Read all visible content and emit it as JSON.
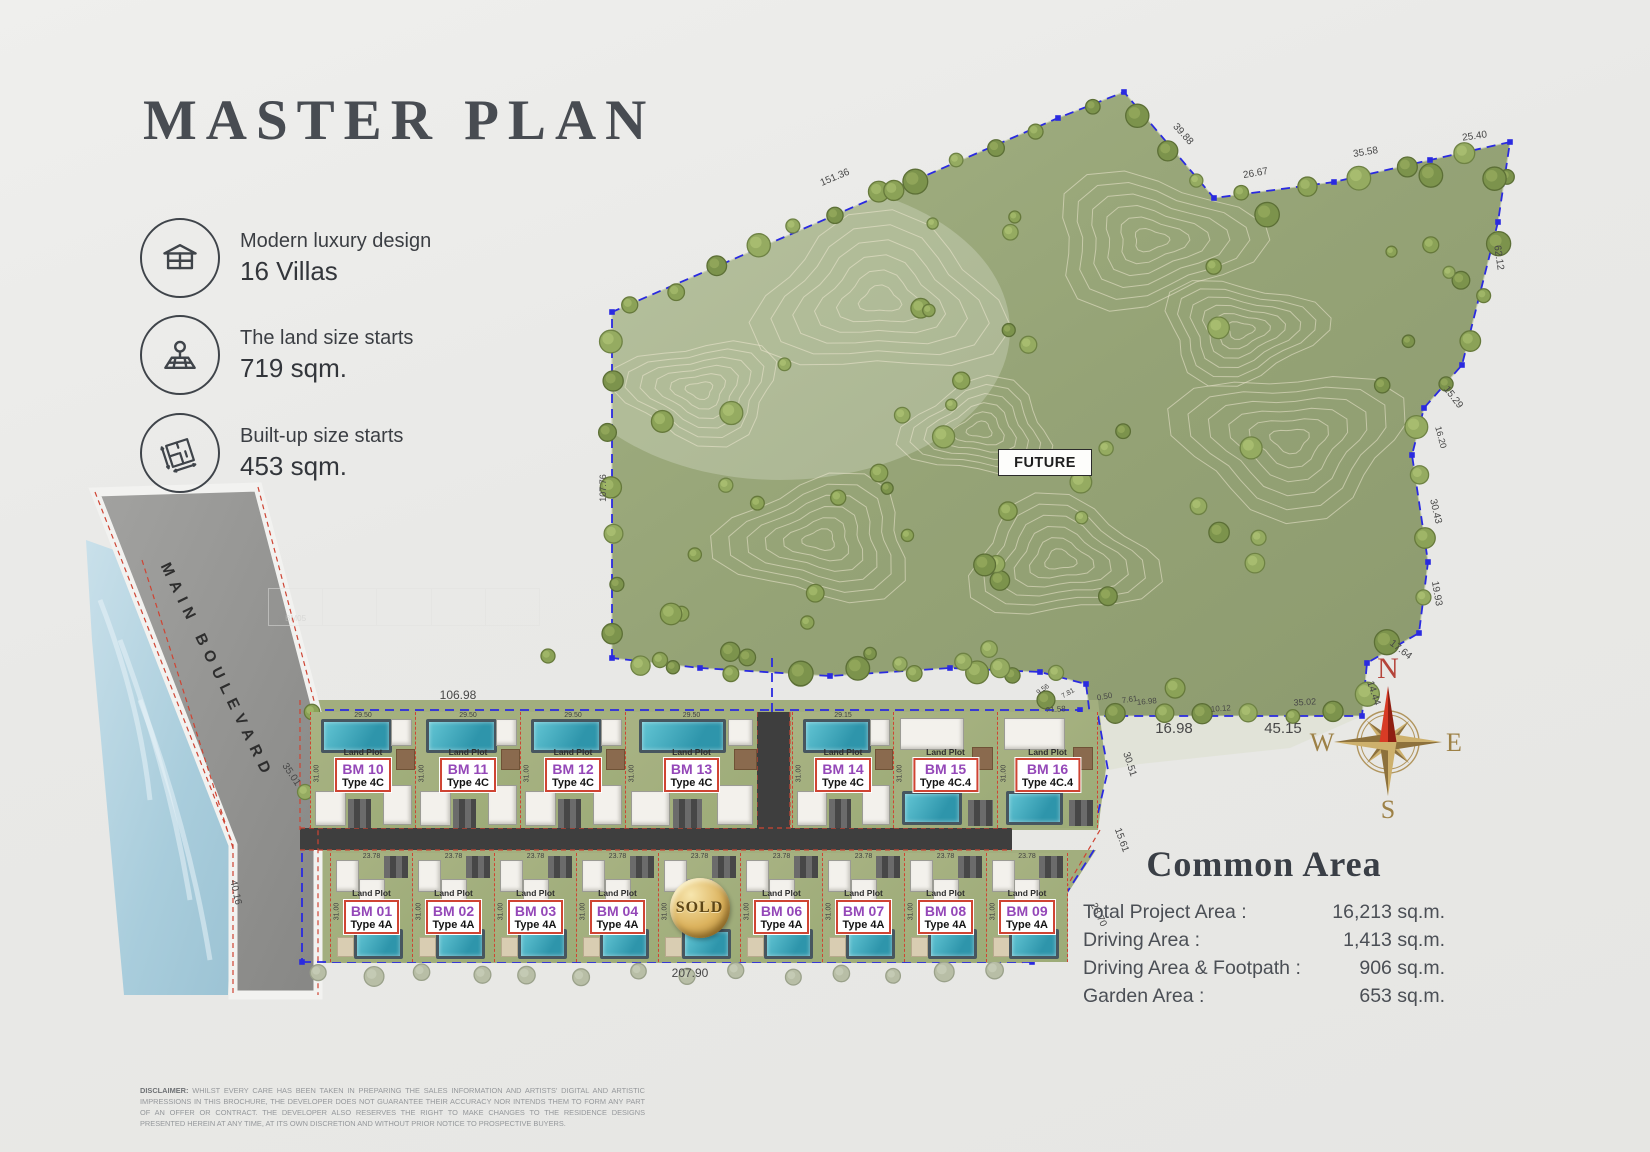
{
  "title": "MASTER PLAN",
  "features": [
    {
      "icon": "villa-icon",
      "line1": "Modern luxury design",
      "line2": "16 Villas"
    },
    {
      "icon": "land-size-icon",
      "line1": "The land size starts",
      "line2": "719 sqm."
    },
    {
      "icon": "built-up-icon",
      "line1": "Built-up size starts",
      "line2": "453 sqm."
    }
  ],
  "map": {
    "future_label": "FUTURE",
    "boulevard_label": "MAIN BOULEVARD",
    "sold_label": "SOLD",
    "land_plot_label": "Land Plot",
    "ghost_label": "BM05",
    "compass": {
      "n": "N",
      "e": "E",
      "s": "S",
      "w": "W"
    },
    "colors": {
      "boundary_blue": "#2a2ae0",
      "boundary_red": "#cf4433",
      "plot_id_purple": "#9447b8",
      "sold_gold": "#dcb35e",
      "grass": "#96a379",
      "pool_teal": "#3ba4b8"
    },
    "top_row_plots": [
      {
        "id": "BM 10",
        "type": "Type 4C",
        "width": "29.50",
        "depth": "31.00",
        "pool": "top"
      },
      {
        "id": "BM 11",
        "type": "Type 4C",
        "width": "29.50",
        "depth": "31.00",
        "pool": "top"
      },
      {
        "id": "BM 12",
        "type": "Type 4C",
        "width": "29.50",
        "depth": "31.00",
        "pool": "top"
      },
      {
        "id": "BM 13",
        "type": "Type 4C",
        "width": "29.50",
        "depth": "31.00",
        "pool": "top"
      },
      {
        "id": "BM 14",
        "type": "Type 4C",
        "width": "29.15",
        "depth": "31.00",
        "pool": "top"
      },
      {
        "id": "BM 15",
        "type": "Type 4C.4",
        "width": "",
        "depth": "31.00",
        "pool": "bottom"
      },
      {
        "id": "BM 16",
        "type": "Type 4C.4",
        "width": "",
        "depth": "31.00",
        "pool": "bottom"
      }
    ],
    "bottom_row_plots": [
      {
        "id": "BM 01",
        "type": "Type 4A",
        "width": "23.78",
        "depth": "31.00"
      },
      {
        "id": "BM 02",
        "type": "Type 4A",
        "width": "23.78",
        "depth": "31.00"
      },
      {
        "id": "BM 03",
        "type": "Type 4A",
        "width": "23.78",
        "depth": "31.00"
      },
      {
        "id": "BM 04",
        "type": "Type 4A",
        "width": "23.78",
        "depth": "31.00"
      },
      {
        "sold": true,
        "width": "23.78",
        "depth": "31.00"
      },
      {
        "id": "BM 06",
        "type": "Type 4A",
        "width": "23.78",
        "depth": "31.00"
      },
      {
        "id": "BM 07",
        "type": "Type 4A",
        "width": "23.78",
        "depth": "31.00"
      },
      {
        "id": "BM 08",
        "type": "Type 4A",
        "width": "23.78",
        "depth": "31.00"
      },
      {
        "id": "BM 09",
        "type": "Type 4A",
        "width": "23.78",
        "depth": "31.00"
      }
    ],
    "dimensions": [
      {
        "t": "151.36",
        "x": 836,
        "y": 180,
        "r": -23,
        "s": 10
      },
      {
        "t": "39.88",
        "x": 1181,
        "y": 136,
        "r": 48,
        "s": 10
      },
      {
        "t": "26.67",
        "x": 1256,
        "y": 176,
        "r": -10,
        "s": 10
      },
      {
        "t": "35.58",
        "x": 1366,
        "y": 155,
        "r": -9,
        "s": 10
      },
      {
        "t": "25.40",
        "x": 1475,
        "y": 139,
        "r": -8,
        "s": 10
      },
      {
        "t": "62.12",
        "x": 1496,
        "y": 258,
        "r": 82,
        "s": 10
      },
      {
        "t": "15.29",
        "x": 1451,
        "y": 399,
        "r": 52,
        "s": 10
      },
      {
        "t": "16.20",
        "x": 1438,
        "y": 438,
        "r": 75,
        "s": 9
      },
      {
        "t": "30.43",
        "x": 1433,
        "y": 512,
        "r": 77,
        "s": 10
      },
      {
        "t": "19.93",
        "x": 1434,
        "y": 594,
        "r": 80,
        "s": 10
      },
      {
        "t": "17.64",
        "x": 1399,
        "y": 652,
        "r": 38,
        "s": 10
      },
      {
        "t": "14.44",
        "x": 1371,
        "y": 694,
        "r": 72,
        "s": 10
      },
      {
        "t": "107.76",
        "x": 606,
        "y": 488,
        "r": -90,
        "s": 9
      },
      {
        "t": "35.02",
        "x": 1305,
        "y": 705,
        "r": -3,
        "s": 9
      },
      {
        "t": "9.56",
        "x": 1044,
        "y": 691,
        "r": -35,
        "s": 7
      },
      {
        "t": "7.81",
        "x": 1069,
        "y": 695,
        "r": -30,
        "s": 7
      },
      {
        "t": "0.50",
        "x": 1105,
        "y": 699,
        "r": -10,
        "s": 8
      },
      {
        "t": "7.61",
        "x": 1130,
        "y": 702,
        "r": -8,
        "s": 8
      },
      {
        "t": "16.98",
        "x": 1147,
        "y": 704,
        "r": -5,
        "s": 8
      },
      {
        "t": "10.12",
        "x": 1221,
        "y": 711,
        "r": -4,
        "s": 8
      },
      {
        "t": "21.58",
        "x": 1056,
        "y": 712,
        "r": -5,
        "s": 8
      },
      {
        "t": "16.98",
        "x": 1174,
        "y": 733,
        "r": 0,
        "s": 15
      },
      {
        "t": "45.15",
        "x": 1283,
        "y": 733,
        "r": 0,
        "s": 15
      },
      {
        "t": "106.98",
        "x": 458,
        "y": 699,
        "r": 0,
        "s": 12
      },
      {
        "t": "207.90",
        "x": 690,
        "y": 977,
        "r": 0,
        "s": 12
      },
      {
        "t": "35.01",
        "x": 289,
        "y": 776,
        "r": 56,
        "s": 10
      },
      {
        "t": "40.16",
        "x": 233,
        "y": 893,
        "r": 78,
        "s": 10
      },
      {
        "t": "30.51",
        "x": 1127,
        "y": 765,
        "r": 72,
        "s": 10
      },
      {
        "t": "15.61",
        "x": 1119,
        "y": 841,
        "r": 70,
        "s": 10
      },
      {
        "t": "28.70",
        "x": 1096,
        "y": 916,
        "r": 64,
        "s": 10
      },
      {
        "t": "29.50",
        "x": 383,
        "y": 816,
        "r": 0,
        "s": 7
      },
      {
        "t": "29.50",
        "x": 487,
        "y": 816,
        "r": 0,
        "s": 7
      },
      {
        "t": "29.50",
        "x": 590,
        "y": 816,
        "r": 0,
        "s": 7
      },
      {
        "t": "29.50",
        "x": 694,
        "y": 816,
        "r": 0,
        "s": 7
      },
      {
        "t": "29.15",
        "x": 833,
        "y": 816,
        "r": 0,
        "s": 7
      }
    ]
  },
  "common_area": {
    "title": "Common Area",
    "rows": [
      {
        "label": "Total Project Area :",
        "value": "16,213 sq.m."
      },
      {
        "label": "Driving Area :",
        "value": "1,413 sq.m."
      },
      {
        "label": "Driving Area & Footpath :",
        "value": "906 sq.m."
      },
      {
        "label": "Garden Area :",
        "value": "653 sq.m."
      }
    ]
  },
  "disclaimer": {
    "label": "DISCLAIMER:",
    "text": " WHILST EVERY CARE HAS BEEN TAKEN IN PREPARING THE SALES INFORMATION AND ARTISTS' DIGITAL AND ARTISTIC IMPRESSIONS IN THIS BROCHURE, THE DEVELOPER DOES NOT GUARANTEE THEIR ACCURACY NOR INTENDS THEM TO FORM ANY PART OF AN OFFER OR CONTRACT. THE DEVELOPER ALSO RESERVES THE RIGHT TO MAKE CHANGES TO THE RESIDENCE DESIGNS PRESENTED HEREIN AT ANY TIME, AT ITS OWN DISCRETION AND WITHOUT PRIOR NOTICE TO PROSPECTIVE BUYERS."
  }
}
